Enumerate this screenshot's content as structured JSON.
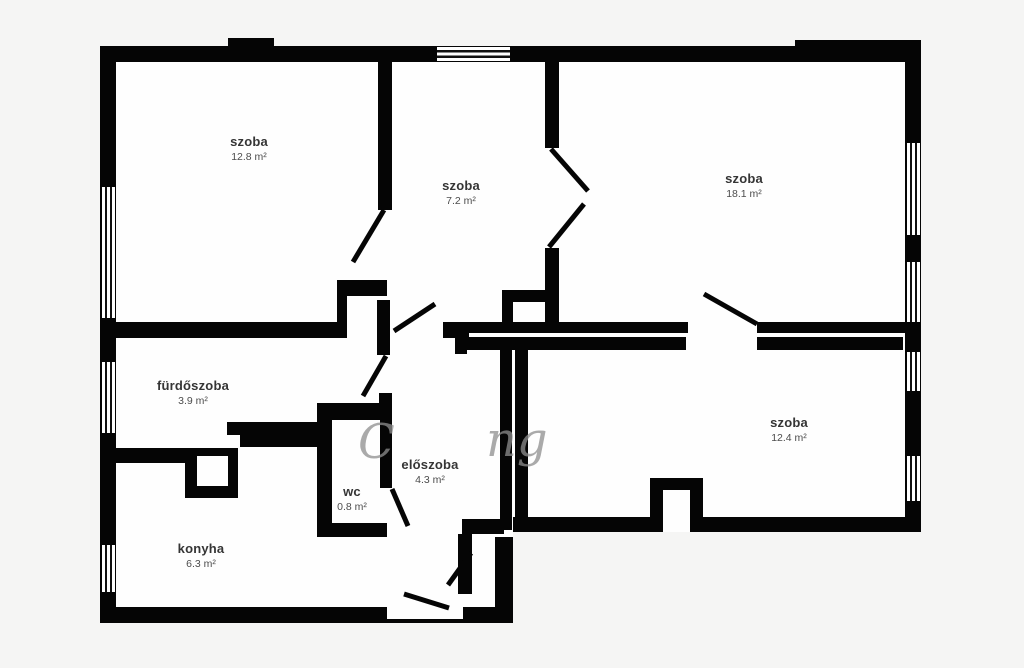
{
  "title": "floor-plan",
  "colors": {
    "background": "#f5f5f4",
    "wall": "#050505",
    "floor": "#fefefe",
    "label_text": "#353535",
    "watermark": "#8f8f8f"
  },
  "rooms": [
    {
      "name": "szoba",
      "area": "12.8 m²"
    },
    {
      "name": "szoba",
      "area": "7.2 m²"
    },
    {
      "name": "szoba",
      "area": "18.1 m²"
    },
    {
      "name": "fürdőszoba",
      "area": "3.9 m²"
    },
    {
      "name": "előszoba",
      "area": "4.3 m²"
    },
    {
      "name": "wc",
      "area": "0.8 m²"
    },
    {
      "name": "konyha",
      "area": "6.3 m²"
    },
    {
      "name": "szoba",
      "area": "12.4 m²"
    }
  ],
  "watermark": {
    "fragment_left": "C",
    "fragment_right": "ng"
  }
}
